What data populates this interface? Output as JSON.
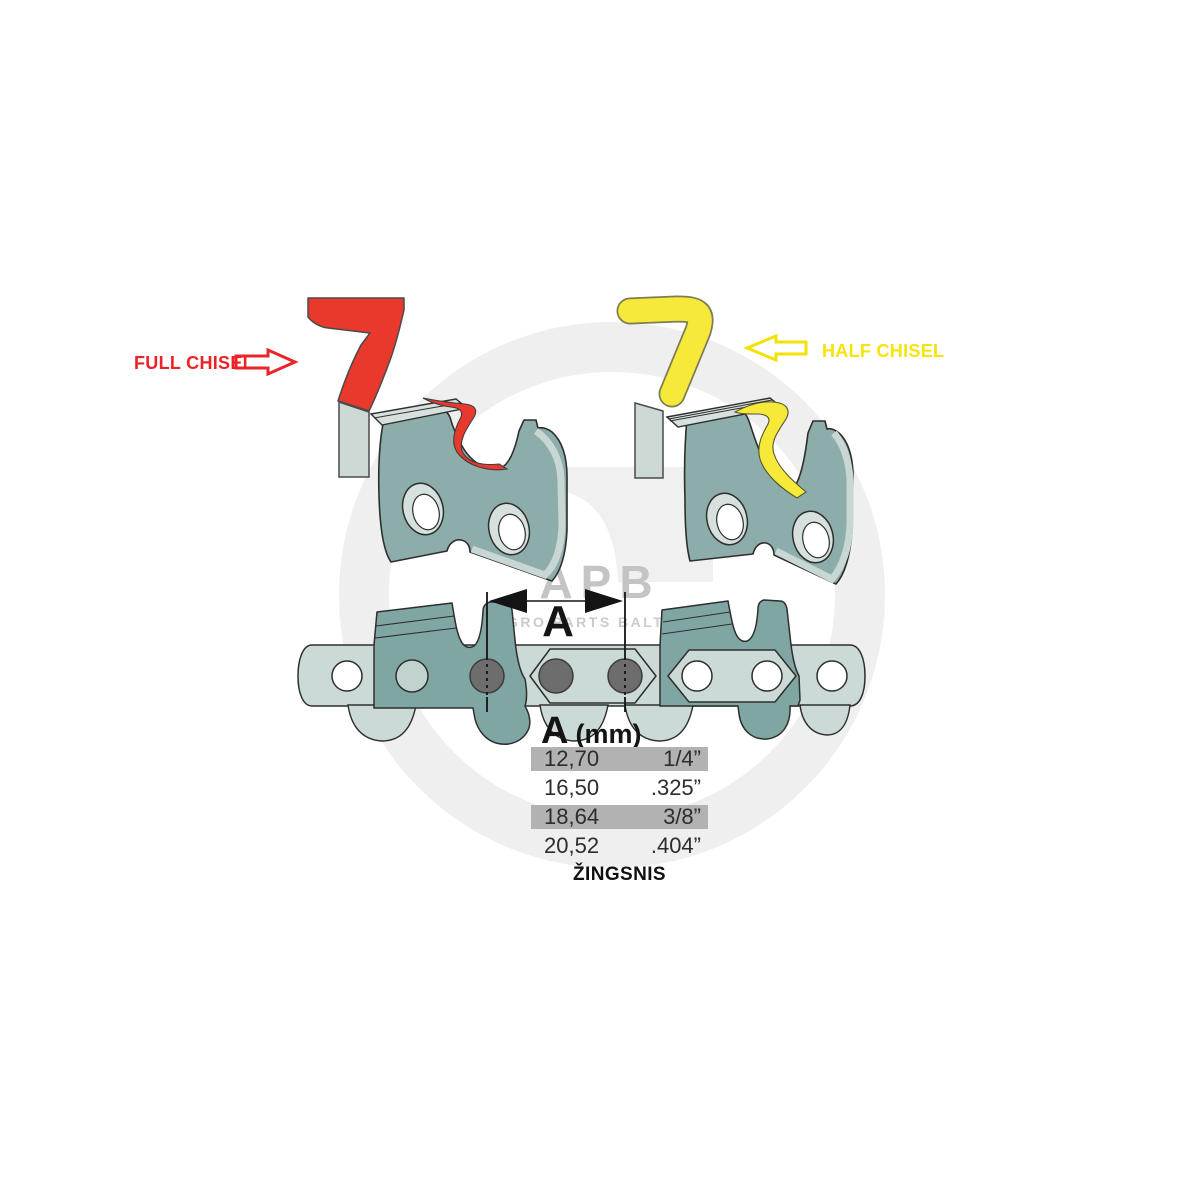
{
  "labels": {
    "full_chisel": "FULL CHISEL",
    "half_chisel": "HALF CHISEL"
  },
  "dimension": {
    "label": "A",
    "header_letter": "A",
    "header_unit": "(mm)",
    "pitch_caption": "ŽINGSNIS"
  },
  "watermark": {
    "logo": "APB",
    "subtitle": "AGRO PARTS BALTIJA"
  },
  "table": {
    "rows": [
      {
        "mm": "12,70",
        "inch": "1/4”",
        "highlighted": true
      },
      {
        "mm": "16,50",
        "inch": ".325”",
        "highlighted": false
      },
      {
        "mm": "18,64",
        "inch": "3/8”",
        "highlighted": true
      },
      {
        "mm": "20,52",
        "inch": ".404”",
        "highlighted": false
      }
    ]
  },
  "colors": {
    "full_chisel_red": "#e9392c",
    "half_chisel_yellow": "#f6e93a",
    "link_body_teal": "#8cadaa",
    "chain_light_teal": "#cbdad6",
    "chain_cutter_teal": "#7fa6a2",
    "table_highlight_grey": "#b2b2b2",
    "outline": "#2e2e2e",
    "watermark_grey": "#c4c4c4"
  }
}
